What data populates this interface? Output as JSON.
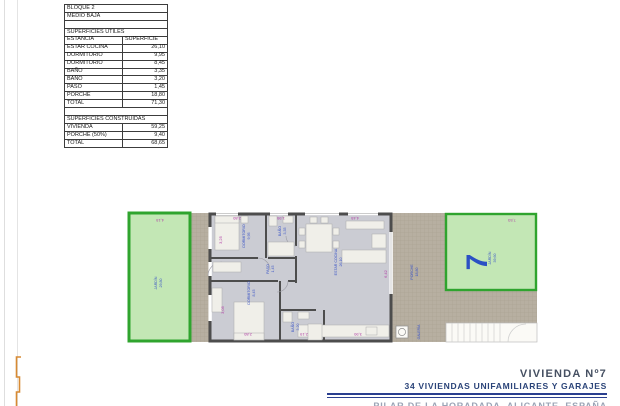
{
  "table": {
    "rows": [
      {
        "label": "BLOQUE 2",
        "value": ""
      },
      {
        "label": "MEDIO BAJA",
        "value": ""
      },
      {
        "label": "",
        "value": ""
      },
      {
        "label": "SUPERFICIES ÚTILES",
        "value": ""
      },
      {
        "label": "ESTANCIA",
        "value": "SUPERFICIE"
      },
      {
        "label": "ESTAR COCINA",
        "value": "26,10"
      },
      {
        "label": "DORMITORIO",
        "value": "9,95"
      },
      {
        "label": "DORMITORIO",
        "value": "8,45"
      },
      {
        "label": "BAÑO",
        "value": "3,35"
      },
      {
        "label": "BAÑO",
        "value": "3,20"
      },
      {
        "label": "PASO",
        "value": "1,45"
      },
      {
        "label": "PORCHE",
        "value": "18,80"
      },
      {
        "label": "TOTAL",
        "value": "71,30"
      },
      {
        "label": "",
        "value": ""
      },
      {
        "label": "SUPERFICIES CONSTRUIDAS",
        "value": ""
      },
      {
        "label": "VIVIENDA",
        "value": "59,25"
      },
      {
        "label": "PORCHE (50%)",
        "value": "9,40"
      },
      {
        "label": "TOTAL",
        "value": "68,65"
      }
    ]
  },
  "plan": {
    "unit_number": "7",
    "jardin_left": {
      "label": "JARDÍN",
      "area": "29,80"
    },
    "jardin_right": {
      "label": "JARDÍN",
      "area": "39,60"
    },
    "rooms": {
      "dormitorio1": {
        "label": "DORMITORIO",
        "area": "9,95"
      },
      "bano1": {
        "label": "BAÑO",
        "area": "3,35"
      },
      "paso": {
        "label": "PASO",
        "area": "1,45"
      },
      "estar_cocina": {
        "label": "ESTAR COCINA",
        "area": "26,10"
      },
      "dormitorio2": {
        "label": "DORMITORIO",
        "area": "8,45"
      },
      "bano2": {
        "label": "BAÑO",
        "area": "3,20"
      },
      "porche": {
        "label": "PORCHE",
        "area": "18,80"
      },
      "galeria": {
        "label": "GALERÍA"
      }
    },
    "dims": {
      "d_415": "4,15",
      "d_280_top": "2,80",
      "d_195": "1,95",
      "d_445": "4,45",
      "d_753": "7,53",
      "d_325": "3,25",
      "d_305": "3,05",
      "d_642": "6,42",
      "d_280_bottom": "2,80",
      "d_219": "2,19",
      "d_390": "3,90"
    }
  },
  "title_block": {
    "project_unit": "VIVIENDA Nº7",
    "project_name": "34 VIVIENDAS UNIFAMILIARES Y GARAJES",
    "location": "PILAR DE LA HORADADA, ALICANTE, ESPAÑA"
  },
  "colors": {
    "garden_fill": "#c3e7b5",
    "garden_stroke": "#2fa42e",
    "wall": "#4d4d4d",
    "floor": "#cbccd3",
    "tile_hatch": "#b7afa1",
    "dimension_text": "#b03ca4",
    "room_label_text": "#3b55c6",
    "unit_number_blue": "#2b50c4",
    "title_navy": "#2a3f8f",
    "orange_mark": "#d78a33"
  }
}
